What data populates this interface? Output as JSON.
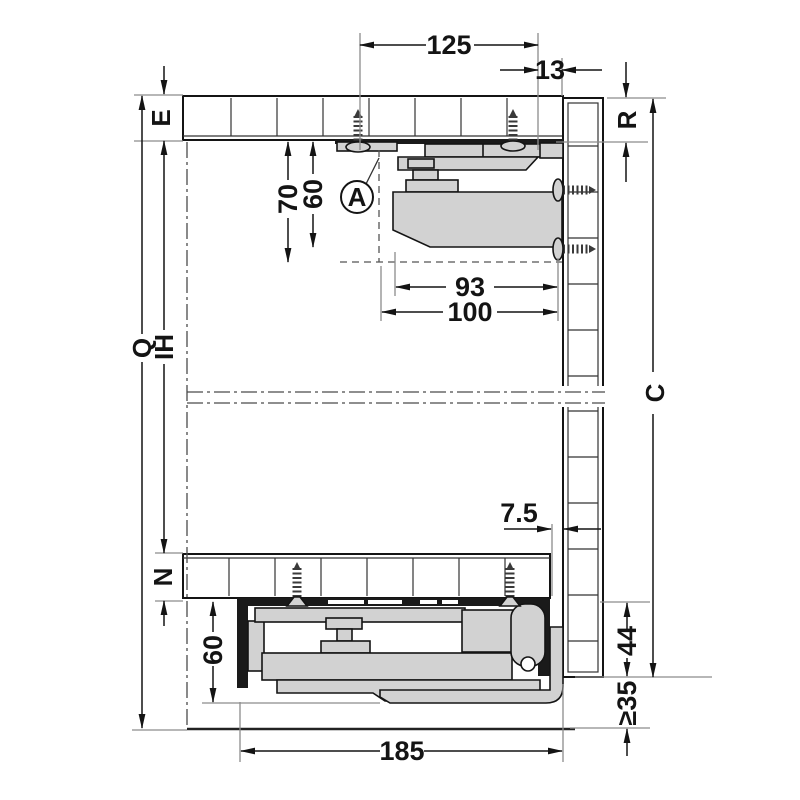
{
  "diagram": {
    "type": "drawer-runner-installation-cross-section",
    "dims": {
      "d125": "125",
      "d13": "13",
      "d70": "70",
      "d60_top": "60",
      "d93": "93",
      "d100": "100",
      "d7_5": "7.5",
      "d60_bottom": "60",
      "d44": "44",
      "d35_min": "≥35",
      "d185": "185"
    },
    "labels": {
      "e": "E",
      "r": "R",
      "q": "Q",
      "ih": "IH",
      "n": "N",
      "c": "C",
      "detail_marker": "A"
    },
    "colors": {
      "part_fill": "#d2d2d2",
      "dark_fill": "#1a1a1a",
      "line": "#141414",
      "extension_line": "#8c8c8c",
      "centerline": "#4a4a4a"
    }
  }
}
